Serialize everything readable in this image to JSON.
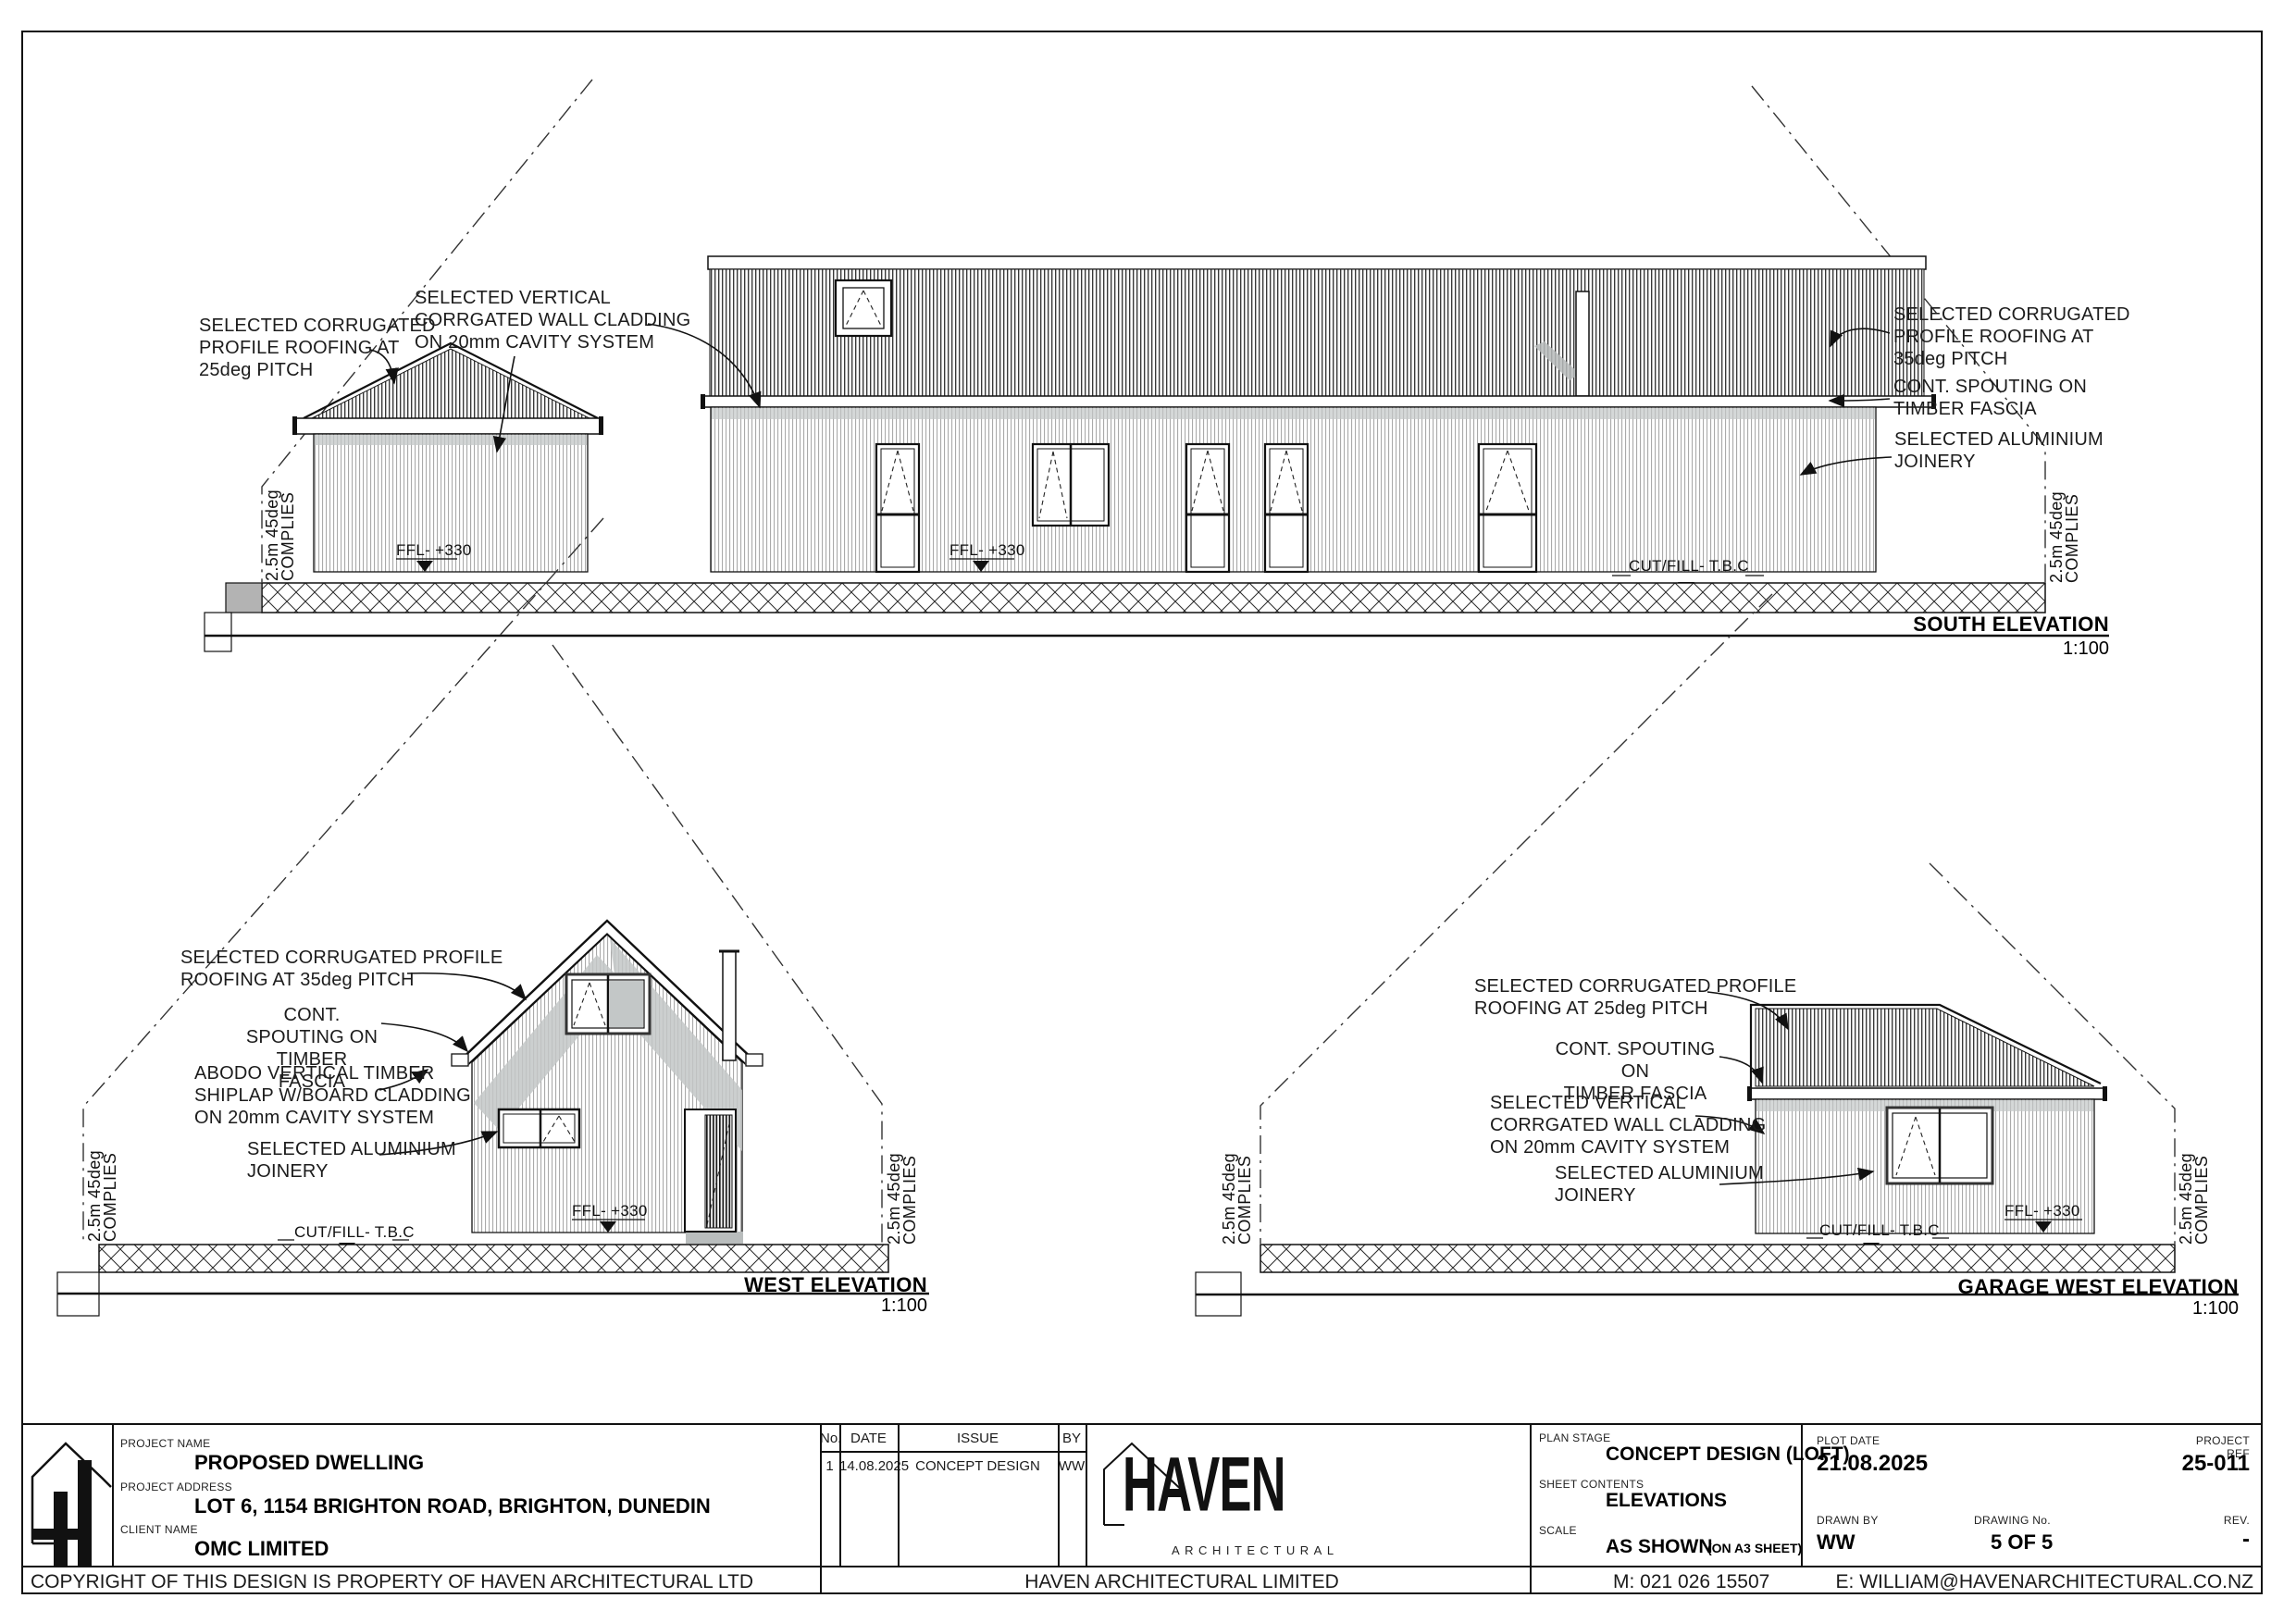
{
  "colors": {
    "ink": "#1a1a1a",
    "shadow_gray": "#c3c7c7",
    "boundary_gray": "#b3b3b3"
  },
  "labels": {
    "ffl": "FFL- +330",
    "cutfill": "CUT/FILL- T.B.C",
    "recession": "2.5m 45deg\nCOMPLIES"
  },
  "elevations": {
    "south": {
      "title": "SOUTH ELEVATION",
      "scale": "1:100",
      "notes": {
        "roof25": "SELECTED CORRUGATED\nPROFILE ROOFING AT\n25deg PITCH",
        "cladding": "SELECTED VERTICAL\nCORRGATED WALL CLADDING\nON 20mm CAVITY SYSTEM",
        "roof35": "SELECTED CORRUGATED\nPROFILE ROOFING AT\n35deg PITCH",
        "spouting": "CONT. SPOUTING ON\nTIMBER FASCIA",
        "joinery": "SELECTED ALUMINIUM\nJOINERY"
      }
    },
    "west": {
      "title": "WEST ELEVATION",
      "scale": "1:100",
      "notes": {
        "roof35": "SELECTED CORRUGATED PROFILE\nROOFING AT 35deg PITCH",
        "spouting": "CONT. SPOUTING ON\nTIMBER FASCIA",
        "abodo": "ABODO VERTICAL TIMBER\nSHIPLAP W/BOARD CLADDING\nON 20mm CAVITY SYSTEM",
        "joinery": "SELECTED ALUMINIUM\nJOINERY"
      }
    },
    "garage": {
      "title": "GARAGE WEST ELEVATION",
      "scale": "1:100",
      "notes": {
        "roof25": "SELECTED CORRUGATED PROFILE\nROOFING AT 25deg PITCH",
        "spouting": "CONT. SPOUTING ON\nTIMBER FASCIA",
        "cladding": "SELECTED VERTICAL\nCORRGATED WALL CLADDING\nON 20mm CAVITY SYSTEM",
        "joinery": "SELECTED ALUMINIUM\nJOINERY"
      }
    }
  },
  "title_block": {
    "labels": {
      "project_name": "PROJECT NAME",
      "project_address": "PROJECT ADDRESS",
      "client_name": "CLIENT NAME",
      "no": "No.",
      "date": "DATE",
      "issue": "ISSUE",
      "by": "BY",
      "plan_stage": "PLAN STAGE",
      "sheet_contents": "SHEET CONTENTS",
      "scale": "SCALE",
      "plot_date": "PLOT DATE",
      "project_ref": "PROJECT REF",
      "drawn_by": "DRAWN BY",
      "drawing_no": "DRAWING No.",
      "rev": "REV."
    },
    "project_name": "PROPOSED DWELLING",
    "project_address": "LOT 6, 1154 BRIGHTON ROAD, BRIGHTON, DUNEDIN",
    "client_name": "OMC LIMITED",
    "revisions": [
      {
        "no": "1",
        "date": "14.08.2025",
        "issue": "CONCEPT DESIGN",
        "by": "WW"
      }
    ],
    "plan_stage": "CONCEPT DESIGN (LOFT)",
    "sheet_contents": "ELEVATIONS",
    "scale_value": "AS SHOWN",
    "scale_note": "(ON A3 SHEET)",
    "plot_date": "21.08.2025",
    "project_ref": "25-011",
    "drawn_by": "WW",
    "drawing_no": "5 OF 5",
    "rev": "-"
  },
  "brand": {
    "name": "HAVEN",
    "tagline": "ARCHITECTURAL"
  },
  "footer": {
    "copyright": "COPYRIGHT OF THIS DESIGN IS PROPERTY OF HAVEN ARCHITECTURAL LTD",
    "company": "HAVEN ARCHITECTURAL LIMITED",
    "mobile": "M: 021 026 15507",
    "email": "E: WILLIAM@HAVENARCHITECTURAL.CO.NZ"
  }
}
